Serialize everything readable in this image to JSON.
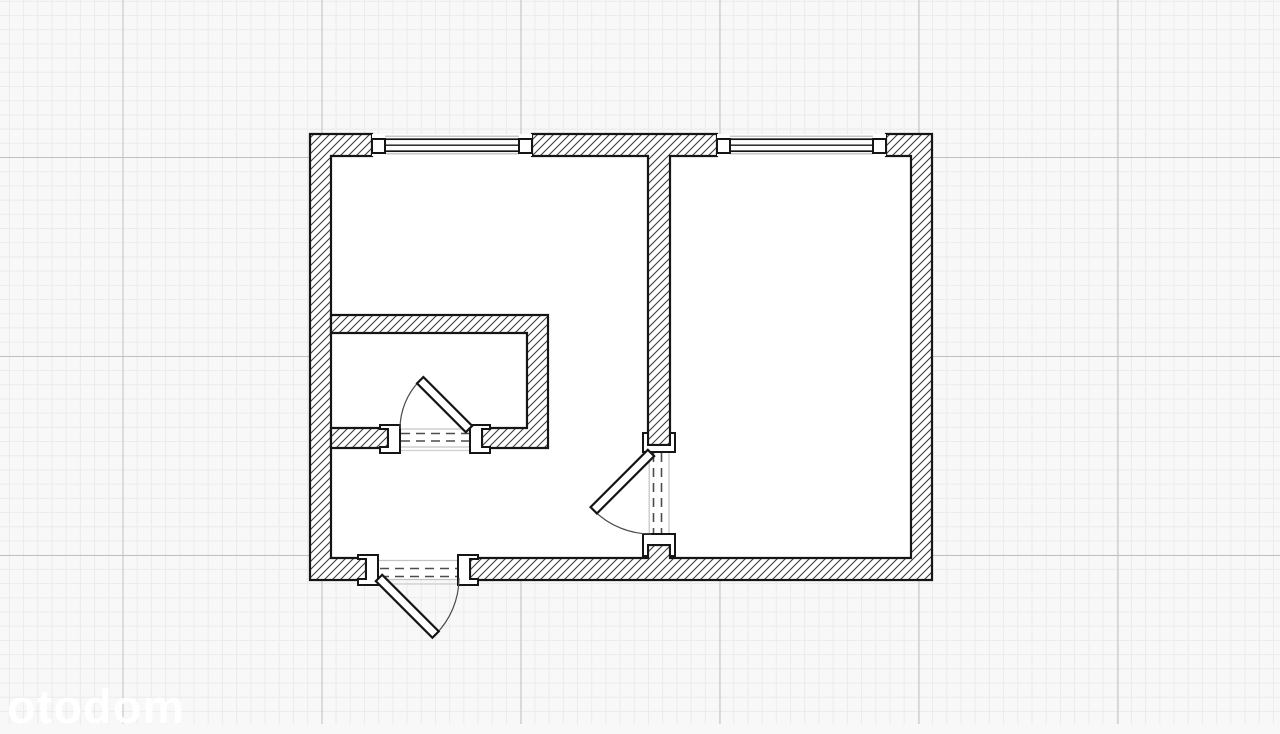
{
  "watermark": {
    "text": "otodom"
  },
  "colors": {
    "background": "#f8f8f8",
    "grid_minor": "#ebebeb",
    "grid_major": "#c0c0c0",
    "wall_stroke": "#151515",
    "hatch_line": "#3d3d3d",
    "window_outer": "#b6b6b6",
    "opening_edge": "#c3c3c3",
    "threshold": "#cfcfcf",
    "dash_line": "#4c4c4c",
    "arc_stroke": "#4a4a4a",
    "white": "#ffffff",
    "watermark_color": "rgba(255,255,255,0.9)"
  },
  "grid": {
    "minor_px": 14.214,
    "major_px": 199,
    "offset_x": 122.5,
    "offset_y": 157
  },
  "floorplan": {
    "canvas": {
      "width": 1280,
      "height": 724
    },
    "elements": [
      {
        "t": "rect",
        "name": "apartment-interior",
        "x": 331,
        "y": 156,
        "w": 580,
        "h": 402,
        "fill": "white"
      },
      {
        "t": "path",
        "name": "outer-wall-left",
        "d": "M310,134 L372,134 L372,156 L331,156 L331,558 L366,558 L366,580 L310,580 Z",
        "fill": "hatch",
        "stroke": "wall_stroke",
        "sw": 2.2
      },
      {
        "t": "path",
        "name": "outer-wall-right-and-bottom",
        "d": "M886,134 L932,134 L932,580 L470,580 L470,558 L648,558 L648,545 L670,545 L670,558 L911,558 L911,156 L886,156 Z",
        "fill": "hatch",
        "stroke": "wall_stroke",
        "sw": 2.2
      },
      {
        "t": "path",
        "name": "top-wall-and-partition",
        "d": "M532,134 L717,134 L717,156 L670,156 L670,445 L648,445 L648,156 L532,156 Z",
        "fill": "hatch",
        "stroke": "wall_stroke",
        "sw": 2.2
      },
      {
        "t": "path",
        "name": "bathroom-walls",
        "d": "M331,315 L548,315 L548,448 L482,448 L482,428 L527,428 L527,333 L331,333 Z",
        "fill": "hatch",
        "stroke": "wall_stroke",
        "sw": 2.2
      },
      {
        "t": "path",
        "name": "bathroom-wall-left-stub",
        "d": "M331,428 L388,428 L388,448 L331,448 Z",
        "fill": "hatch",
        "stroke": "wall_stroke",
        "sw": 2.2
      },
      {
        "t": "rect",
        "name": "window-1-base",
        "x": 372,
        "y": 134,
        "w": 160,
        "h": 22,
        "fill": "white"
      },
      {
        "t": "line",
        "name": "window-1-outer-top",
        "x1": 385,
        "y1": 136.2,
        "x2": 519,
        "y2": 136.2,
        "stroke": "window_outer",
        "sw": 1.2
      },
      {
        "t": "line",
        "name": "window-1-outer-bottom",
        "x1": 385,
        "y1": 153.8,
        "x2": 519,
        "y2": 153.8,
        "stroke": "window_outer",
        "sw": 1.2
      },
      {
        "t": "rect",
        "name": "window-1-frame",
        "x": 385,
        "y": 139.2,
        "w": 134,
        "h": 12,
        "fill": "white",
        "stroke": "wall_stroke",
        "sw": 1.7
      },
      {
        "t": "line",
        "name": "window-1-glass-line",
        "x1": 385,
        "y1": 145.2,
        "x2": 519,
        "y2": 145.2,
        "stroke": "wall_stroke",
        "sw": 1.4
      },
      {
        "t": "rect",
        "name": "window-1-jamb-left",
        "x": 372,
        "y": 139,
        "w": 13,
        "h": 14,
        "fill": "white",
        "stroke": "wall_stroke",
        "sw": 2
      },
      {
        "t": "rect",
        "name": "window-1-jamb-right",
        "x": 519,
        "y": 139,
        "w": 13,
        "h": 14,
        "fill": "white",
        "stroke": "wall_stroke",
        "sw": 2
      },
      {
        "t": "rect",
        "name": "window-2-base",
        "x": 717,
        "y": 134,
        "w": 169,
        "h": 22,
        "fill": "white"
      },
      {
        "t": "line",
        "name": "window-2-outer-top",
        "x1": 730,
        "y1": 136.2,
        "x2": 873,
        "y2": 136.2,
        "stroke": "window_outer",
        "sw": 1.2
      },
      {
        "t": "line",
        "name": "window-2-outer-bottom",
        "x1": 730,
        "y1": 153.8,
        "x2": 873,
        "y2": 153.8,
        "stroke": "window_outer",
        "sw": 1.2
      },
      {
        "t": "rect",
        "name": "window-2-frame",
        "x": 730,
        "y": 139.2,
        "w": 143,
        "h": 12,
        "fill": "white",
        "stroke": "wall_stroke",
        "sw": 1.7
      },
      {
        "t": "line",
        "name": "window-2-glass-line",
        "x1": 730,
        "y1": 145.2,
        "x2": 873,
        "y2": 145.2,
        "stroke": "wall_stroke",
        "sw": 1.4
      },
      {
        "t": "rect",
        "name": "window-2-jamb-left",
        "x": 717,
        "y": 139,
        "w": 13,
        "h": 14,
        "fill": "white",
        "stroke": "wall_stroke",
        "sw": 2
      },
      {
        "t": "rect",
        "name": "window-2-jamb-right",
        "x": 873,
        "y": 139,
        "w": 13,
        "h": 14,
        "fill": "white",
        "stroke": "wall_stroke",
        "sw": 2
      },
      {
        "t": "rect",
        "name": "entrance-door-opening",
        "x": 378,
        "y": 558,
        "w": 80,
        "h": 22,
        "fill": "white"
      },
      {
        "t": "line",
        "name": "entrance-opening-edge-top",
        "x1": 378,
        "y1": 560.5,
        "x2": 458,
        "y2": 560.5,
        "stroke": "opening_edge",
        "sw": 1.2
      },
      {
        "t": "line",
        "name": "entrance-opening-edge-bottom",
        "x1": 378,
        "y1": 579.5,
        "x2": 458,
        "y2": 579.5,
        "stroke": "opening_edge",
        "sw": 1.2
      },
      {
        "t": "line",
        "name": "entrance-threshold",
        "x1": 379,
        "y1": 584,
        "x2": 458,
        "y2": 584,
        "stroke": "threshold",
        "sw": 1.2
      },
      {
        "t": "line",
        "name": "entrance-dash-1",
        "x1": 380,
        "y1": 568.5,
        "x2": 457,
        "y2": 568.5,
        "stroke": "dash_line",
        "sw": 1.6,
        "dash": "9 6"
      },
      {
        "t": "line",
        "name": "entrance-dash-2",
        "x1": 380,
        "y1": 576.5,
        "x2": 457,
        "y2": 576.5,
        "stroke": "dash_line",
        "sw": 1.6,
        "dash": "9 6"
      },
      {
        "t": "rect",
        "name": "bathroom-door-opening",
        "x": 400,
        "y": 428,
        "w": 70,
        "h": 20,
        "fill": "white"
      },
      {
        "t": "line",
        "name": "bathroom-opening-edge-top",
        "x1": 400,
        "y1": 429,
        "x2": 470,
        "y2": 429,
        "stroke": "opening_edge",
        "sw": 1.2
      },
      {
        "t": "line",
        "name": "bathroom-opening-edge-bottom",
        "x1": 400,
        "y1": 447,
        "x2": 470,
        "y2": 447,
        "stroke": "opening_edge",
        "sw": 1.2
      },
      {
        "t": "line",
        "name": "bathroom-threshold",
        "x1": 400,
        "y1": 450.5,
        "x2": 470,
        "y2": 450.5,
        "stroke": "threshold",
        "sw": 1.2
      },
      {
        "t": "line",
        "name": "bathroom-dash-1",
        "x1": 401,
        "y1": 433.5,
        "x2": 469,
        "y2": 433.5,
        "stroke": "dash_line",
        "sw": 1.6,
        "dash": "9 6"
      },
      {
        "t": "line",
        "name": "bathroom-dash-2",
        "x1": 401,
        "y1": 441,
        "x2": 469,
        "y2": 441,
        "stroke": "dash_line",
        "sw": 1.6,
        "dash": "9 6"
      },
      {
        "t": "rect",
        "name": "room-door-opening",
        "x": 648,
        "y": 452,
        "w": 22,
        "h": 82,
        "fill": "white"
      },
      {
        "t": "line",
        "name": "room-opening-edge-left",
        "x1": 649.2,
        "y1": 452,
        "x2": 649.2,
        "y2": 534,
        "stroke": "opening_edge",
        "sw": 1.2
      },
      {
        "t": "line",
        "name": "room-opening-edge-right",
        "x1": 669,
        "y1": 452,
        "x2": 669,
        "y2": 534,
        "stroke": "opening_edge",
        "sw": 1.2
      },
      {
        "t": "line",
        "name": "room-dash-1",
        "x1": 653.5,
        "y1": 453,
        "x2": 653.5,
        "y2": 533,
        "stroke": "dash_line",
        "sw": 1.6,
        "dash": "9 6"
      },
      {
        "t": "line",
        "name": "room-dash-2",
        "x1": 661.5,
        "y1": 453,
        "x2": 661.5,
        "y2": 533,
        "stroke": "dash_line",
        "sw": 1.6,
        "dash": "9 6"
      },
      {
        "t": "path",
        "name": "entrance-jamb-left",
        "d": "M358,555 L378,555 L378,585 L358,585 L358,579 L366,579 L366,559 L358,559 Z",
        "fill": "white",
        "stroke": "wall_stroke",
        "sw": 2
      },
      {
        "t": "path",
        "name": "entrance-jamb-right",
        "d": "M478,555 L458,555 L458,585 L478,585 L478,579 L470,579 L470,559 L478,559 Z",
        "fill": "white",
        "stroke": "wall_stroke",
        "sw": 2
      },
      {
        "t": "path",
        "name": "bathroom-jamb-left",
        "d": "M380,425 L400,425 L400,453 L380,453 L380,447 L388,447 L388,429 L380,429 Z",
        "fill": "white",
        "stroke": "wall_stroke",
        "sw": 2
      },
      {
        "t": "path",
        "name": "bathroom-jamb-right",
        "d": "M470,425 L490,425 L490,429 L482,429 L482,447 L490,447 L490,453 L470,453 Z",
        "fill": "white",
        "stroke": "wall_stroke",
        "sw": 2
      },
      {
        "t": "path",
        "name": "room-jamb-top",
        "d": "M643,433 L648,433 L648,445 L670,445 L670,433 L675,433 L675,452 L643,452 Z",
        "fill": "white",
        "stroke": "wall_stroke",
        "sw": 2
      },
      {
        "t": "path",
        "name": "room-jamb-bottom",
        "d": "M643,534 L675,534 L675,556 L670,556 L670,545 L648,545 L648,556 L643,556 Z",
        "fill": "white",
        "stroke": "wall_stroke",
        "sw": 2
      },
      {
        "t": "path",
        "name": "entrance-door-arc",
        "d": "M435.5,634.5 A80,80 0 0 0 459,578",
        "fill": "none",
        "stroke": "arc_stroke",
        "sw": 1.2
      },
      {
        "t": "rect",
        "name": "entrance-door-leaf",
        "x": 379,
        "y": 573.5,
        "w": 80,
        "h": 9,
        "fill": "white",
        "stroke": "wall_stroke",
        "sw": 2.2,
        "rot": [
          45,
          379,
          578
        ]
      },
      {
        "t": "path",
        "name": "bathroom-door-arc",
        "d": "M420.2,380.2 A69,69 0 0 0 400,429",
        "fill": "none",
        "stroke": "arc_stroke",
        "sw": 1.2
      },
      {
        "t": "rect",
        "name": "bathroom-door-leaf",
        "x": 469,
        "y": 424.5,
        "w": 69,
        "h": 9,
        "fill": "white",
        "stroke": "wall_stroke",
        "sw": 2.2,
        "rot": [
          -135,
          469,
          429
        ]
      },
      {
        "t": "path",
        "name": "room-door-arc",
        "d": "M593.7,510.3 A81,81 0 0 0 651,534",
        "fill": "none",
        "stroke": "arc_stroke",
        "sw": 1.2
      },
      {
        "t": "rect",
        "name": "room-door-leaf",
        "x": 651,
        "y": 448.5,
        "w": 81,
        "h": 9,
        "fill": "white",
        "stroke": "wall_stroke",
        "sw": 2.2,
        "rot": [
          135,
          651,
          453
        ]
      }
    ]
  }
}
